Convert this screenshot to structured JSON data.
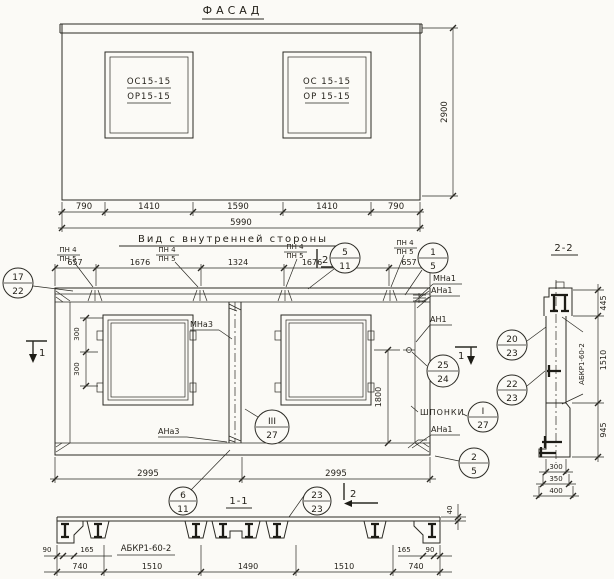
{
  "colors": {
    "ink": "#2b2a24",
    "paper": "#fbfaf6"
  },
  "facade": {
    "title": "ФАСАД",
    "window_left": {
      "top": "ОС15-15",
      "bottom": "ОР15-15"
    },
    "window_right": {
      "top": "ОС 15-15",
      "bottom": "ОР 15-15"
    },
    "dims": {
      "d1": "790",
      "d2": "1410",
      "d3": "1590",
      "d4": "1410",
      "d5": "790",
      "total": "5990",
      "height": "2900"
    }
  },
  "inner": {
    "title": "Вид с внутренней стороны",
    "dims_top": {
      "d1": "657",
      "d2": "1676",
      "d3": "1324",
      "d4": "1676",
      "d5": "657"
    },
    "pn": {
      "top": "ПН 4",
      "bottom": "ПН 5"
    },
    "labels": {
      "mna3": "МНа3",
      "ana3": "АНа3",
      "mna1": "МНа1",
      "ana1_top": "АНа1",
      "an1": "АН1",
      "shponki": "ШПОНКИ",
      "ana1_bottom": "АНа1"
    },
    "dims": {
      "v300a": "300",
      "v300b": "300",
      "v1800": "1800",
      "b_left": "2995",
      "b_right": "2995"
    },
    "marks": {
      "one": "1",
      "two": "2"
    }
  },
  "sec11": {
    "title": "1-1",
    "label": "АБКР1-60-2",
    "dims_small": {
      "l90": "90",
      "l165": "165",
      "r165": "165",
      "r90": "90",
      "t40": "40"
    },
    "dims_main": {
      "d1": "740",
      "d2": "1510",
      "d3": "1490",
      "d4": "1510",
      "d5": "740"
    }
  },
  "sec22": {
    "title": "2-2",
    "label": "АБКР1-60-2",
    "dims_right": {
      "d1": "445",
      "d2": "1510",
      "d3": "945"
    },
    "dims_bottom": {
      "d1": "300",
      "d2": "350",
      "d3": "400"
    }
  },
  "callouts": {
    "c17_22": {
      "top": "17",
      "bottom": "22"
    },
    "c5_11": {
      "top": "5",
      "bottom": "11"
    },
    "c1_5": {
      "top": "1",
      "bottom": "5"
    },
    "c25_24": {
      "top": "25",
      "bottom": "24"
    },
    "cI_27": {
      "top": "I",
      "bottom": "27"
    },
    "cIII_27": {
      "top": "III",
      "bottom": "27"
    },
    "c2_5": {
      "top": "2",
      "bottom": "5"
    },
    "c6_11": {
      "top": "6",
      "bottom": "11"
    },
    "c23_23": {
      "top": "23",
      "bottom": "23"
    },
    "c20_23": {
      "top": "20",
      "bottom": "23"
    },
    "c22_23": {
      "top": "22",
      "bottom": "23"
    }
  }
}
